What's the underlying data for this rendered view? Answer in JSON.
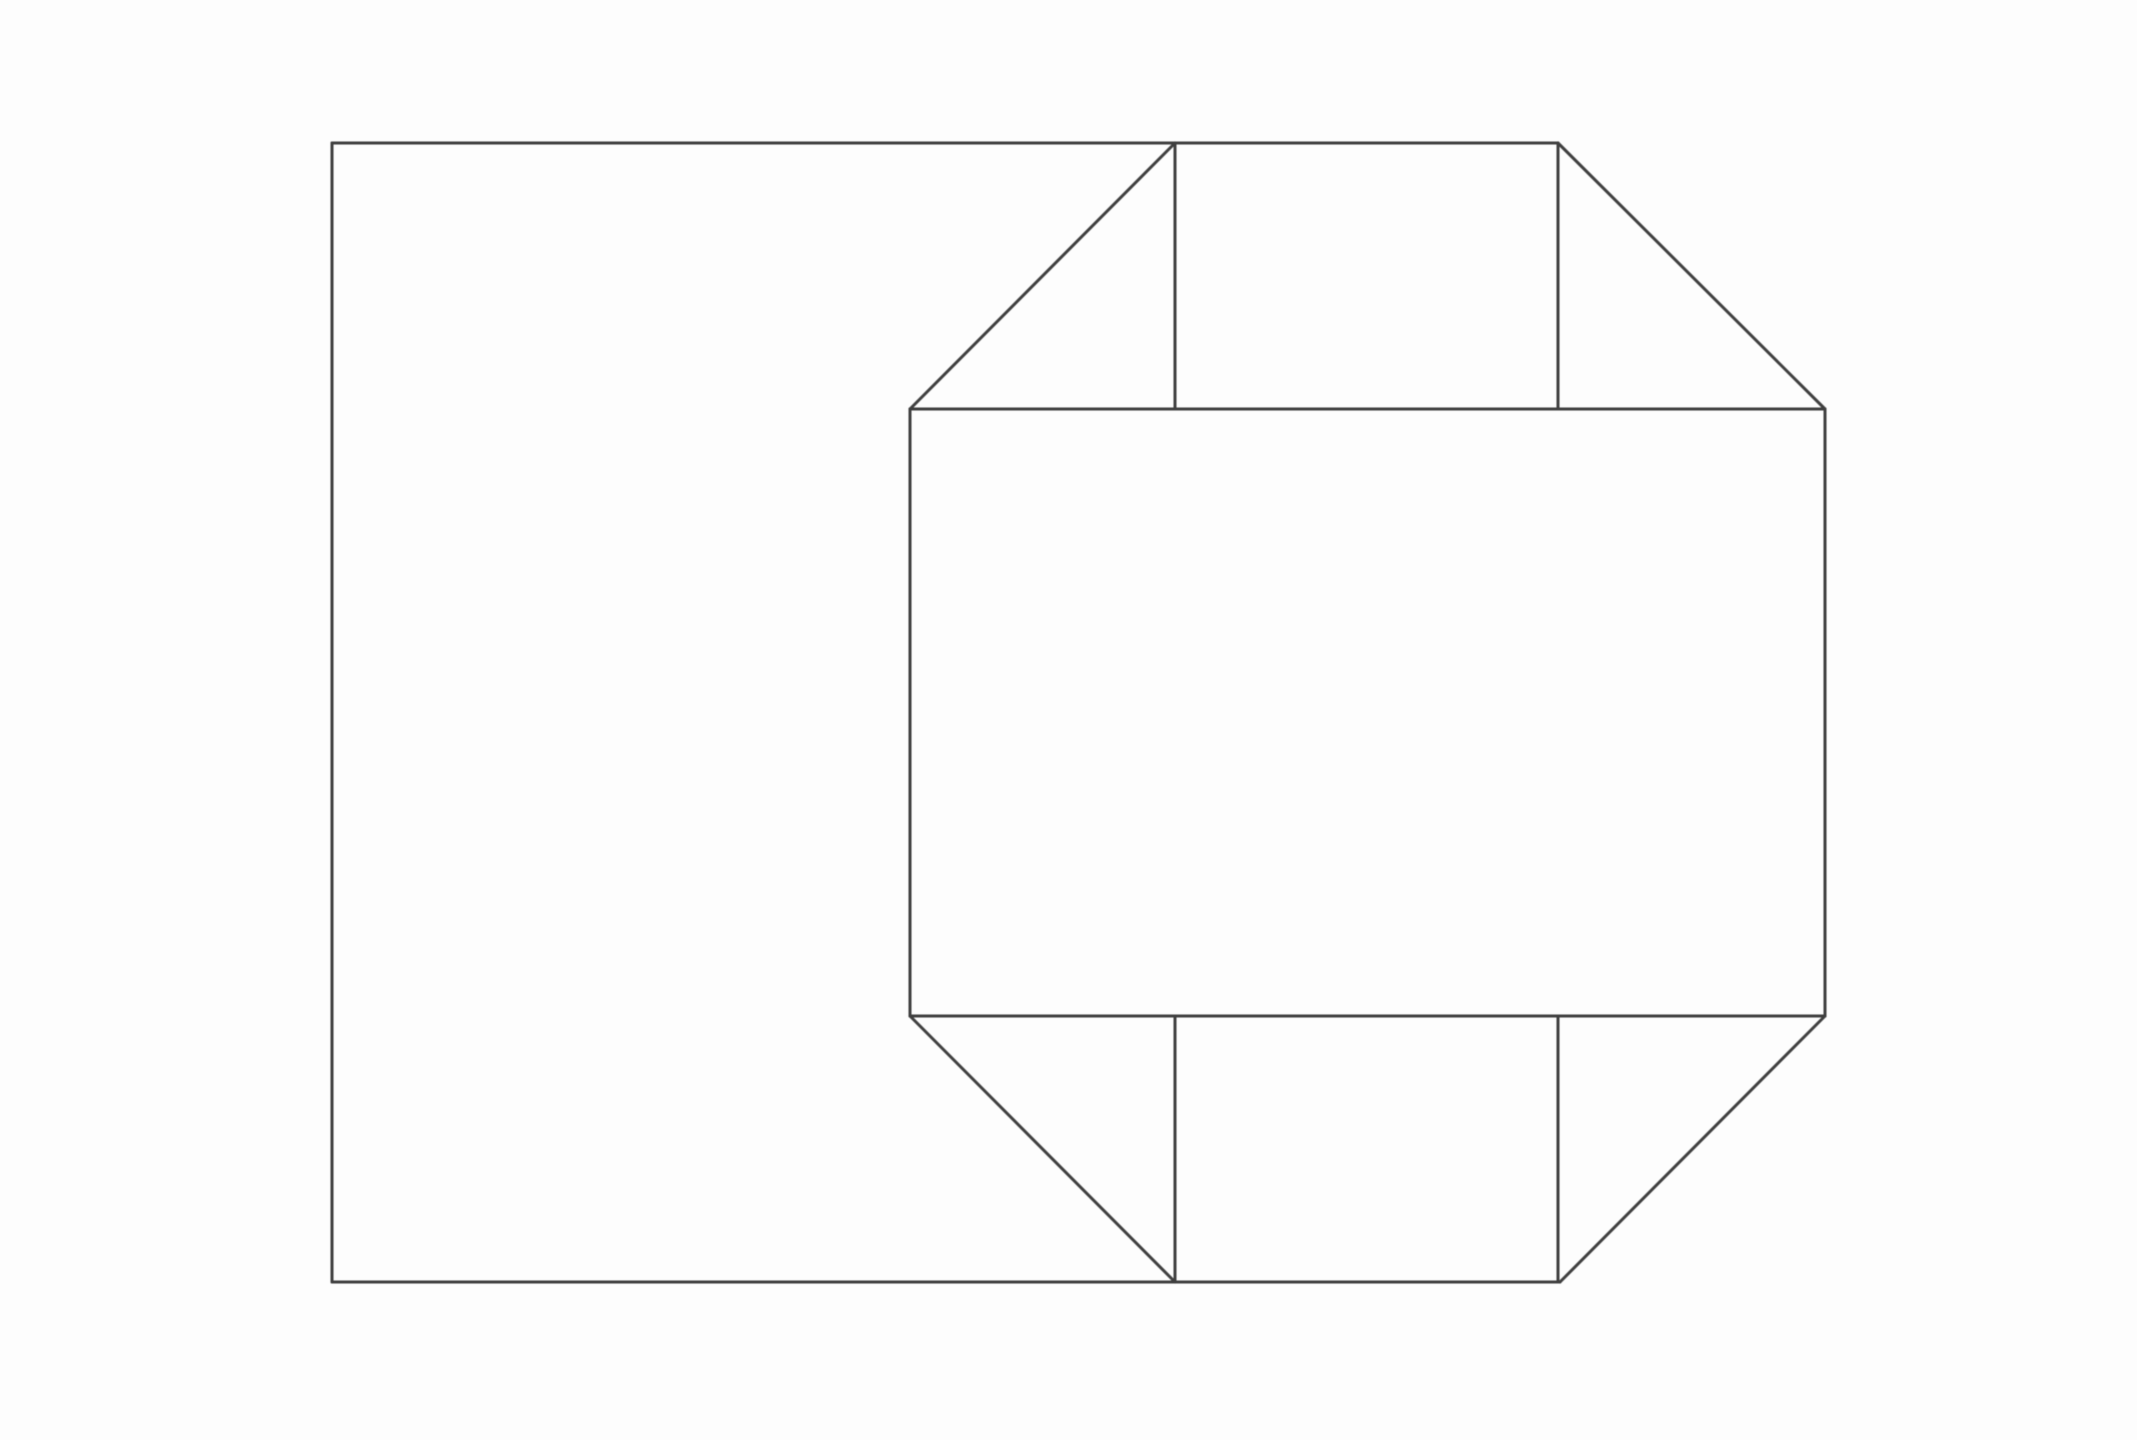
{
  "figure": {
    "description": "Black-and-white line drawing: a large rectangle on the left overlapping a chamfered octagon (box with open corner flaps) on the right; top and bottom edges of both shapes are collinear and drawn as single continuous lines",
    "background_color": "#fdfdfd",
    "stroke_color": "#3f3f3f",
    "stroke_width": 3,
    "canvas": {
      "width": 2137,
      "height": 1440
    },
    "shapes": {
      "left_rectangle": {
        "x1": 332,
        "y1": 143,
        "x2": 1175,
        "y2": 1282
      },
      "octagon": {
        "left_x": 910,
        "right_x": 1825,
        "top_y": 143,
        "bottom_y": 1282,
        "upper_shoulder_y": 409,
        "lower_shoulder_y": 1016,
        "inner_left_x": 1175,
        "inner_right_x": 1558
      }
    },
    "segments": [
      {
        "name": "rect-left-edge",
        "x1": 332,
        "y1": 143,
        "x2": 332,
        "y2": 1282
      },
      {
        "name": "top-edge",
        "x1": 332,
        "y1": 143,
        "x2": 1558,
        "y2": 143
      },
      {
        "name": "bottom-edge",
        "x1": 332,
        "y1": 1282,
        "x2": 1560,
        "y2": 1282
      },
      {
        "name": "octagon-left-edge",
        "x1": 910,
        "y1": 409,
        "x2": 910,
        "y2": 1016
      },
      {
        "name": "octagon-right-edge",
        "x1": 1825,
        "y1": 409,
        "x2": 1825,
        "y2": 1016
      },
      {
        "name": "upper-inner-horizontal",
        "x1": 910,
        "y1": 409,
        "x2": 1825,
        "y2": 409
      },
      {
        "name": "lower-inner-horizontal",
        "x1": 910,
        "y1": 1016,
        "x2": 1825,
        "y2": 1016
      },
      {
        "name": "top-left-chamfer",
        "x1": 910,
        "y1": 409,
        "x2": 1175,
        "y2": 143
      },
      {
        "name": "top-right-chamfer",
        "x1": 1558,
        "y1": 143,
        "x2": 1825,
        "y2": 409
      },
      {
        "name": "bottom-left-chamfer",
        "x1": 910,
        "y1": 1016,
        "x2": 1175,
        "y2": 1282
      },
      {
        "name": "bottom-right-chamfer",
        "x1": 1825,
        "y1": 1016,
        "x2": 1560,
        "y2": 1282
      },
      {
        "name": "top-flap-left-vertical",
        "x1": 1175,
        "y1": 143,
        "x2": 1175,
        "y2": 409
      },
      {
        "name": "top-flap-right-vertical",
        "x1": 1558,
        "y1": 143,
        "x2": 1558,
        "y2": 409
      },
      {
        "name": "bottom-flap-left-vertical",
        "x1": 1175,
        "y1": 1016,
        "x2": 1175,
        "y2": 1282
      },
      {
        "name": "bottom-flap-right-vertical",
        "x1": 1558,
        "y1": 1016,
        "x2": 1558,
        "y2": 1282
      }
    ]
  }
}
